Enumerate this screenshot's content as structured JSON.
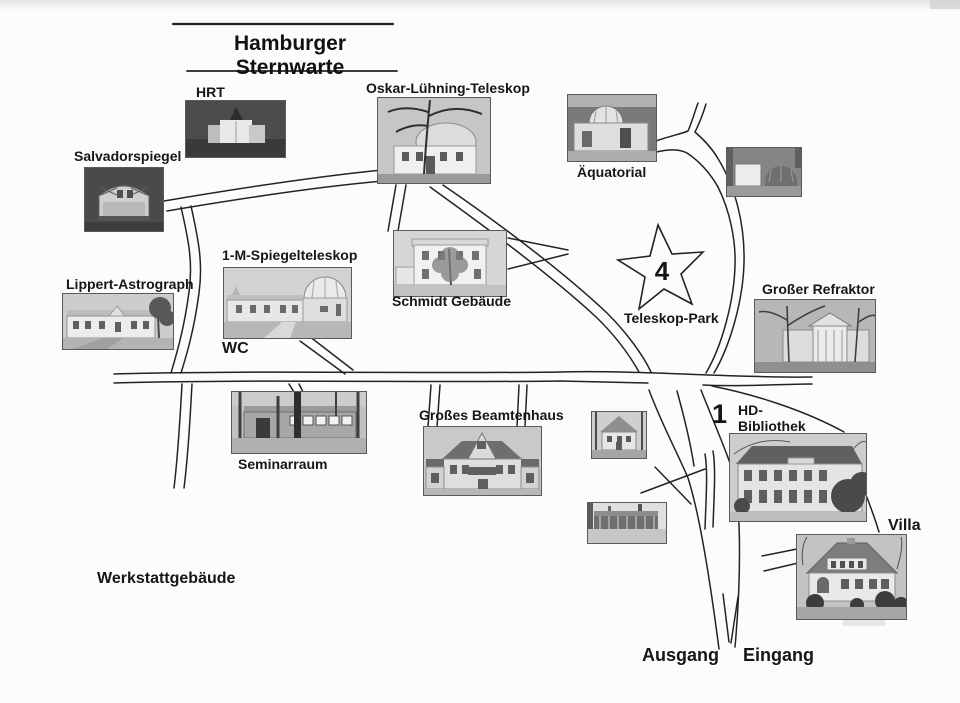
{
  "title": {
    "text": "Hamburger Sternwarte"
  },
  "labels": {
    "hrt": "HRT",
    "oskar_luehning_teleskop": "Oskar-Lühning-Teleskop",
    "salvadorspiegel": "Salvadorspiegel",
    "aequatorial": "Äquatorial",
    "spiegelteleskop_1m": "1-M-Spiegelteleskop",
    "wc": "WC",
    "schmidt_gebaeude": "Schmidt Gebäude",
    "lippert_astrograph": "Lippert-Astrograph",
    "teleskop_park": "Teleskop-Park",
    "grosser_refraktor": "Großer Refraktor",
    "grosses_beamtenhaus": "Großes Beamtenhaus",
    "seminarraum": "Seminarraum",
    "hd_bibliothek_line1": "HD-",
    "hd_bibliothek_line2": "Bibliothek",
    "villa": "Villa",
    "werkstattgebaeude": "Werkstattgebäude",
    "ausgang": "Ausgang",
    "eingang": "Eingang"
  },
  "markers": {
    "teleskop_park_star": "4",
    "hd_bibliothek": "1"
  },
  "colors": {
    "ink": "#1c1c1c",
    "paper": "#fcfcfc"
  }
}
